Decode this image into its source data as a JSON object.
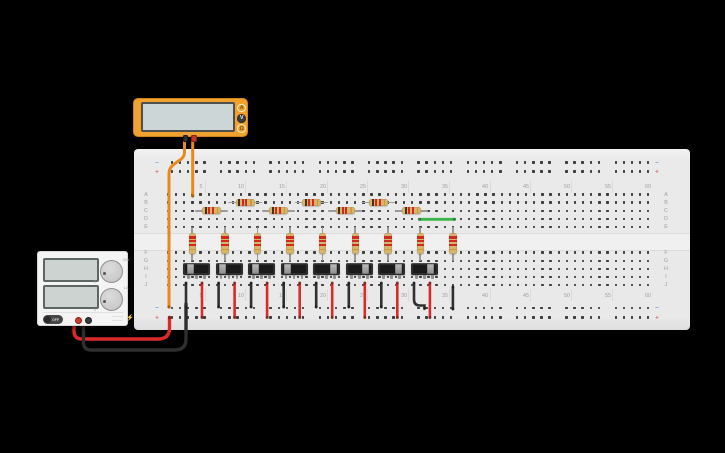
{
  "app": {
    "background": "#000000"
  },
  "multimeter": {
    "body_color": "#f0a22e",
    "display_color": "#ccd6d6",
    "buttons": [
      {
        "label": "A",
        "active": false
      },
      {
        "label": "V",
        "active": true
      },
      {
        "label": "Ω",
        "active": false
      }
    ],
    "probes": [
      {
        "name": "black-probe",
        "color": "#2f2f2f"
      },
      {
        "name": "red-probe",
        "color": "#c23527"
      }
    ]
  },
  "power_supply": {
    "power_button_label": "OFF",
    "voltage_knob": {
      "min_label": "0",
      "max_label": "30V"
    },
    "current_knob": {
      "min_label": "0",
      "max_label": "1A"
    },
    "lightning_icon": "⚡",
    "terminals": [
      {
        "name": "positive-terminal",
        "color": "#cf3a2a",
        "ring": "#8c2015",
        "x": 37
      },
      {
        "name": "negative-terminal",
        "color": "#3a3a3a",
        "ring": "#1e1e1e",
        "x": 46.5
      }
    ]
  },
  "breadboard": {
    "rows_top": [
      "A",
      "B",
      "C",
      "D",
      "E"
    ],
    "rows_bottom": [
      "F",
      "G",
      "H",
      "I",
      "J"
    ],
    "column_numbers": [
      5,
      10,
      15,
      20,
      25,
      30,
      35,
      40,
      45,
      50,
      55,
      60
    ],
    "columns": 60,
    "bus_minus": "−",
    "bus_plus": "+",
    "bus_minus_color": "#6f9fd8",
    "bus_plus_color": "#d86f6f"
  },
  "resistors": {
    "body_color": "#d7b56d",
    "lead_color": "#9b9b9b",
    "band_colors_horizontal": [
      "#4a2c18",
      "#cf2a1f",
      "#cf2a1f",
      "#c79a3f"
    ],
    "band_colors_vertical": [
      "#cf2a1f",
      "#cf2a1f",
      "#cf2a1f",
      "#c79a3f"
    ],
    "horizontal": [
      {
        "x1": 195,
        "x2": 228,
        "y": 210.8,
        "row": "C"
      },
      {
        "x1": 228,
        "x2": 262,
        "y": 202.6,
        "row": "B"
      },
      {
        "x1": 262,
        "x2": 295,
        "y": 210.8,
        "row": "C"
      },
      {
        "x1": 295,
        "x2": 328,
        "y": 202.6,
        "row": "B"
      },
      {
        "x1": 328,
        "x2": 362,
        "y": 210.8,
        "row": "C"
      },
      {
        "x1": 362,
        "x2": 395,
        "y": 202.6,
        "row": "B"
      },
      {
        "x1": 395,
        "x2": 428,
        "y": 210.8,
        "row": "C"
      }
    ],
    "vertical_x": [
      192.4,
      225.0,
      257.6,
      290.1,
      322.7,
      355.3,
      387.8,
      420.3,
      452.9
    ],
    "vertical_y1": 227.1,
    "vertical_y2": 260.8
  },
  "switches": {
    "y": 262.5,
    "centers": [
      196.5,
      229.0,
      261.6,
      294.2,
      326.7,
      359.3,
      391.8,
      424.4
    ],
    "states": [
      "left",
      "left",
      "left",
      "left",
      "right",
      "right",
      "right",
      "right"
    ]
  },
  "wires": [
    {
      "name": "multimeter-black-lead-wire",
      "color": "#e8891b",
      "width": 3,
      "path": "M184.5,139 L184.5,152 C184.5,163 169,161 169,174 L169,307",
      "dots": [
        [
          169,
          307
        ]
      ]
    },
    {
      "name": "multimeter-red-lead-wire",
      "color": "#e8891b",
      "width": 3,
      "path": "M192.7,139 L192.7,196",
      "dots": [
        [
          192.7,
          196
        ]
      ]
    },
    {
      "name": "psu-red-wire",
      "color": "#d92b2b",
      "width": 3.4,
      "path": "M74,321 L74,331 Q74,339 82,339 L158,339 Q169.5,339 169.5,328 L169.5,317.5",
      "dots": [
        [
          169.5,
          317.5
        ]
      ]
    },
    {
      "name": "psu-black-wire",
      "color": "#2e2e2e",
      "width": 3.4,
      "path": "M83.5,321 L83.5,342 Q83.5,350 91,350 L174.5,350 Q186,350 186,339 L186,304",
      "dots": [
        [
          186,
          304
        ]
      ]
    },
    {
      "name": "green-jumper-wire",
      "color": "#3bb54a",
      "width": 2.8,
      "path": "M419.5,219.3 L454.5,219.3",
      "dots": [
        [
          419.5,
          219.3
        ],
        [
          454.5,
          219.3
        ]
      ]
    },
    {
      "name": "black-jumper-wire",
      "color": "#303030",
      "width": 2.6,
      "path": "M186,283 L186,307",
      "dots": [
        [
          186,
          283
        ],
        [
          186,
          307
        ]
      ]
    },
    {
      "name": "black-jumper-wire",
      "color": "#303030",
      "width": 2.6,
      "path": "M218.6,283 L218.6,307",
      "dots": [
        [
          218.6,
          283
        ],
        [
          218.6,
          307
        ]
      ]
    },
    {
      "name": "black-jumper-wire",
      "color": "#303030",
      "width": 2.6,
      "path": "M251.1,283 L251.1,307",
      "dots": [
        [
          251.1,
          283
        ],
        [
          251.1,
          307
        ]
      ]
    },
    {
      "name": "black-jumper-wire",
      "color": "#303030",
      "width": 2.6,
      "path": "M283.7,283 L283.7,307",
      "dots": [
        [
          283.7,
          283
        ],
        [
          283.7,
          307
        ]
      ]
    },
    {
      "name": "black-jumper-wire",
      "color": "#303030",
      "width": 2.6,
      "path": "M316.2,283 L316.2,307",
      "dots": [
        [
          316.2,
          283
        ],
        [
          316.2,
          307
        ]
      ]
    },
    {
      "name": "black-jumper-wire",
      "color": "#303030",
      "width": 2.6,
      "path": "M348.8,283 L348.8,307",
      "dots": [
        [
          348.8,
          283
        ],
        [
          348.8,
          307
        ]
      ]
    },
    {
      "name": "black-jumper-wire",
      "color": "#303030",
      "width": 2.6,
      "path": "M381.3,283 L381.3,307",
      "dots": [
        [
          381.3,
          283
        ],
        [
          381.3,
          307
        ]
      ]
    },
    {
      "name": "black-elbow-jumper-wire",
      "color": "#303030",
      "width": 2.6,
      "path": "M414,283 L414,299.5 Q414,305.5 420,305.5 L424.5,305.5 L424.5,308.5",
      "dots": [
        [
          414,
          283
        ],
        [
          424.5,
          308.5
        ]
      ]
    },
    {
      "name": "terminator-black-wire",
      "color": "#303030",
      "width": 2.6,
      "path": "M452.9,287 L452.9,309",
      "dots": [
        [
          452.9,
          287
        ],
        [
          452.9,
          309
        ]
      ]
    },
    {
      "name": "red-jumper-wire",
      "color": "#d92b2b",
      "width": 2.6,
      "path": "M202,283 L202,317.5",
      "dots": [
        [
          202,
          283
        ],
        [
          202,
          317.5
        ]
      ]
    },
    {
      "name": "red-jumper-wire",
      "color": "#d92b2b",
      "width": 2.6,
      "path": "M234.6,283 L234.6,317.5",
      "dots": [
        [
          234.6,
          283
        ],
        [
          234.6,
          317.5
        ]
      ]
    },
    {
      "name": "red-jumper-wire",
      "color": "#d92b2b",
      "width": 2.6,
      "path": "M267.1,283 L267.1,317.5",
      "dots": [
        [
          267.1,
          283
        ],
        [
          267.1,
          317.5
        ]
      ]
    },
    {
      "name": "red-jumper-wire",
      "color": "#d92b2b",
      "width": 2.6,
      "path": "M299.7,283 L299.7,317.5",
      "dots": [
        [
          299.7,
          283
        ],
        [
          299.7,
          317.5
        ]
      ]
    },
    {
      "name": "red-jumper-wire",
      "color": "#d92b2b",
      "width": 2.6,
      "path": "M332.2,283 L332.2,317.5",
      "dots": [
        [
          332.2,
          283
        ],
        [
          332.2,
          317.5
        ]
      ]
    },
    {
      "name": "red-jumper-wire",
      "color": "#d92b2b",
      "width": 2.6,
      "path": "M364.8,283 L364.8,317.5",
      "dots": [
        [
          364.8,
          283
        ],
        [
          364.8,
          317.5
        ]
      ]
    },
    {
      "name": "red-jumper-wire",
      "color": "#d92b2b",
      "width": 2.6,
      "path": "M397.3,283 L397.3,317.5",
      "dots": [
        [
          397.3,
          283
        ],
        [
          397.3,
          317.5
        ]
      ]
    },
    {
      "name": "red-jumper-wire",
      "color": "#d92b2b",
      "width": 2.6,
      "path": "M429.9,283 L429.9,317.5",
      "dots": [
        [
          429.9,
          283
        ],
        [
          429.9,
          317.5
        ]
      ]
    }
  ]
}
